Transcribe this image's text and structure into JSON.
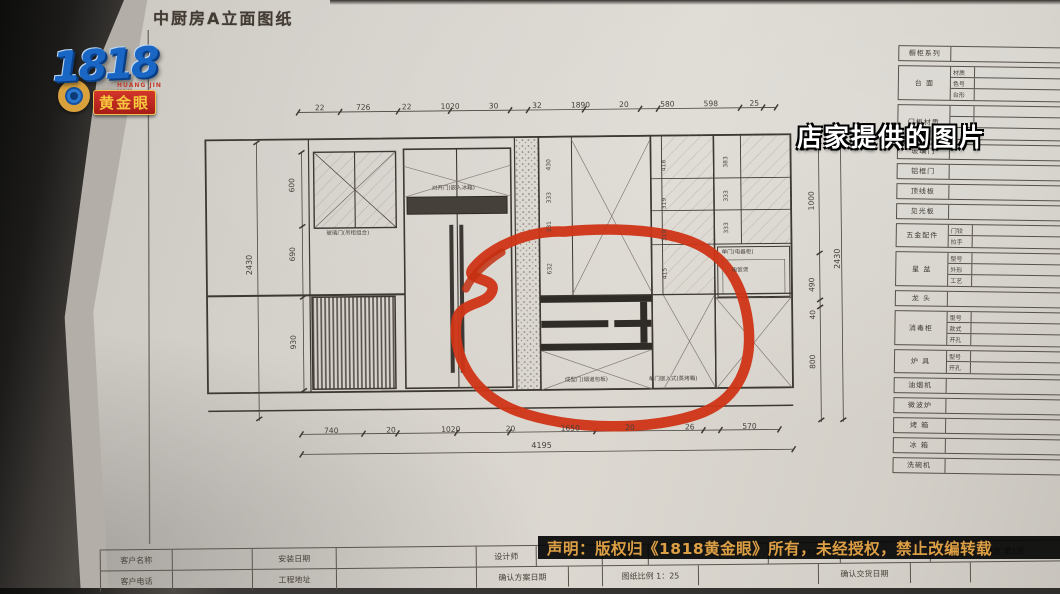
{
  "broadcast": {
    "logo": {
      "number": "1818",
      "pinyin": "HUANG JIN YAN",
      "badge": "黄金眼"
    },
    "caption": "店家提供的图片",
    "disclaimer": "声明：版权归《1818黄金眼》所有，未经授权，禁止改编转载"
  },
  "sheet": {
    "title": "中厨房A立面图纸",
    "labels": {
      "glass_upper": "玻璃门(吊柜组合)",
      "fridge": "对开门(嵌入冰箱)",
      "appliance_door": "单门(电器柜)",
      "rice_cooker": "电饭煲",
      "flue_panel": "成型门(烟道包板)",
      "built_in_oven": "单门嵌入式(蒸烤箱)"
    },
    "dims": {
      "top": [
        "22",
        "726",
        "22",
        "1020",
        "30",
        "32",
        "1890",
        "20",
        "580",
        "598",
        "25"
      ],
      "bottom": [
        "740",
        "20",
        "1020",
        "20",
        "1650",
        "20",
        "26",
        "570"
      ],
      "bottom_total": "4195",
      "left": [
        "600",
        "690",
        "930"
      ],
      "left_total": "2430",
      "right": [
        "1000",
        "490",
        "40",
        "800"
      ],
      "right_total": "2430",
      "cab_col1": [
        "430",
        "333",
        "331",
        "632"
      ],
      "cab_col2": [
        "418",
        "319",
        "319",
        "415"
      ],
      "cab_col3": [
        "383",
        "333",
        "333"
      ]
    },
    "spec_table": {
      "rows": [
        {
          "label": "橱柜系列",
          "subs": []
        },
        {
          "label": "台 面",
          "subs": [
            "材质",
            "色号",
            "台形"
          ]
        },
        {
          "label": "门板材质",
          "subs": [
            "",
            "",
            ""
          ]
        },
        {
          "label": "玻璃门",
          "subs": []
        },
        {
          "label": "铝框门",
          "subs": []
        },
        {
          "label": "顶线板",
          "subs": []
        },
        {
          "label": "见光板",
          "subs": []
        },
        {
          "label": "五金配件",
          "subs": [
            "门铰",
            "拉手"
          ]
        },
        {
          "label": "星 盆",
          "subs": [
            "型号",
            "外形",
            "工艺"
          ]
        },
        {
          "label": "龙 头",
          "subs": []
        },
        {
          "label": "消毒柜",
          "subs": [
            "型号",
            "款式",
            "开孔"
          ]
        },
        {
          "label": "炉 具",
          "subs": [
            "型号",
            "开孔"
          ]
        },
        {
          "label": "油烟机",
          "subs": []
        },
        {
          "label": "微波炉",
          "subs": []
        },
        {
          "label": "烤 箱",
          "subs": []
        },
        {
          "label": "冰 箱",
          "subs": []
        },
        {
          "label": "洗碗机",
          "subs": []
        }
      ]
    },
    "footer": {
      "row1": [
        "客户名称",
        "",
        "安装日期",
        "",
        "设计师",
        "",
        "电话",
        "",
        "服务经理",
        "",
        "共4页 第1页"
      ],
      "row2": [
        "客户电话",
        "",
        "工程地址",
        "",
        "确认方案日期",
        "",
        "图纸比例 1：25",
        "",
        "确认交货日期",
        "",
        ""
      ]
    }
  }
}
